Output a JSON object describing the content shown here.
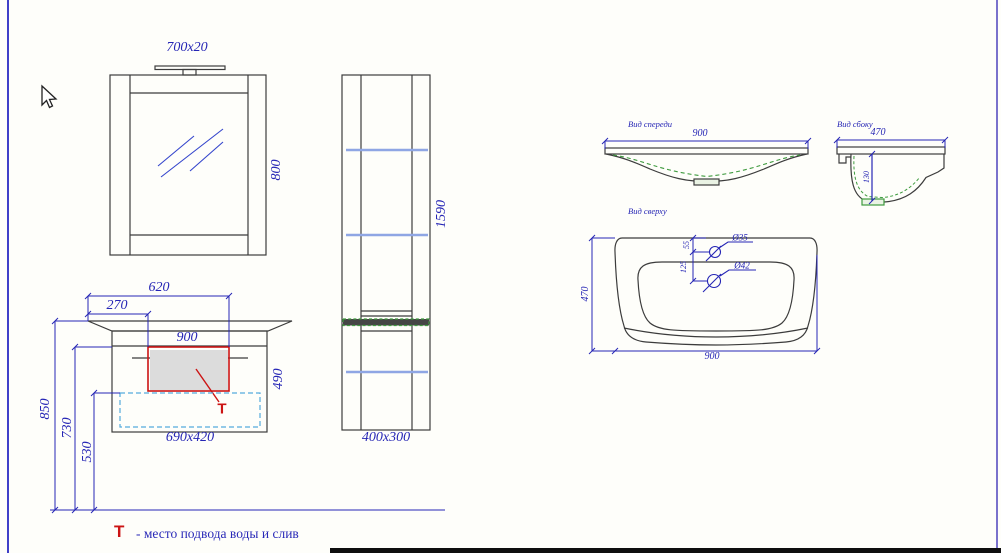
{
  "colors": {
    "dimension_blue": "#2525b5",
    "drawing_line": "#3c3c3c",
    "shelf_blue": "#8fa6e4",
    "highlight_green": "#3f9b3f",
    "marker_red": "#cc1414",
    "dashed_box_cyan": "#55aadd",
    "panel_gray_fill": "#dcdcdc"
  },
  "mirror": {
    "dim_lamp": "700x20",
    "dim_height": "800"
  },
  "tall_cabinet": {
    "dim_height": "1590",
    "dim_footprint": "400x300"
  },
  "vanity": {
    "dim_620": "620",
    "dim_270": "270",
    "dim_900": "900",
    "dim_490": "490",
    "dim_footprint": "690x420",
    "dim_850": "850",
    "dim_730": "730",
    "dim_530": "530",
    "t_marker": "T"
  },
  "sink_front": {
    "label": "Вид спереди",
    "dim_width": "900"
  },
  "sink_side": {
    "label": "Вид сбоку",
    "dim_width": "470",
    "dim_depth": "130"
  },
  "sink_top": {
    "label": "Вид сверху",
    "dim_depth": "470",
    "dim_width": "900",
    "dim_hole_offset": "55",
    "dim_hole_spacing": "125",
    "hole_small": "Ø35",
    "hole_large": "Ø42"
  },
  "legend": {
    "symbol": "T",
    "text": "- место подвода воды и слив"
  }
}
